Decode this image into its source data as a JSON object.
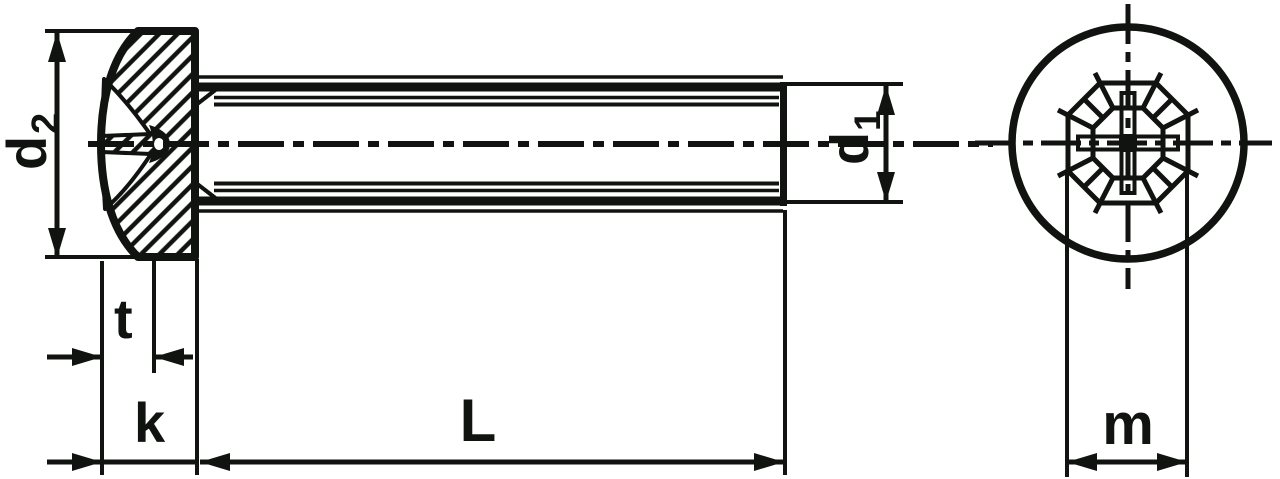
{
  "drawing": {
    "labels": {
      "d2": {
        "base": "d",
        "sub": "2"
      },
      "d1": {
        "base": "d",
        "sub": "1"
      },
      "t": "t",
      "k": "k",
      "length": "L",
      "m": "m"
    },
    "colors": {
      "ink": "#10130f",
      "paper": "#ffffff"
    }
  }
}
